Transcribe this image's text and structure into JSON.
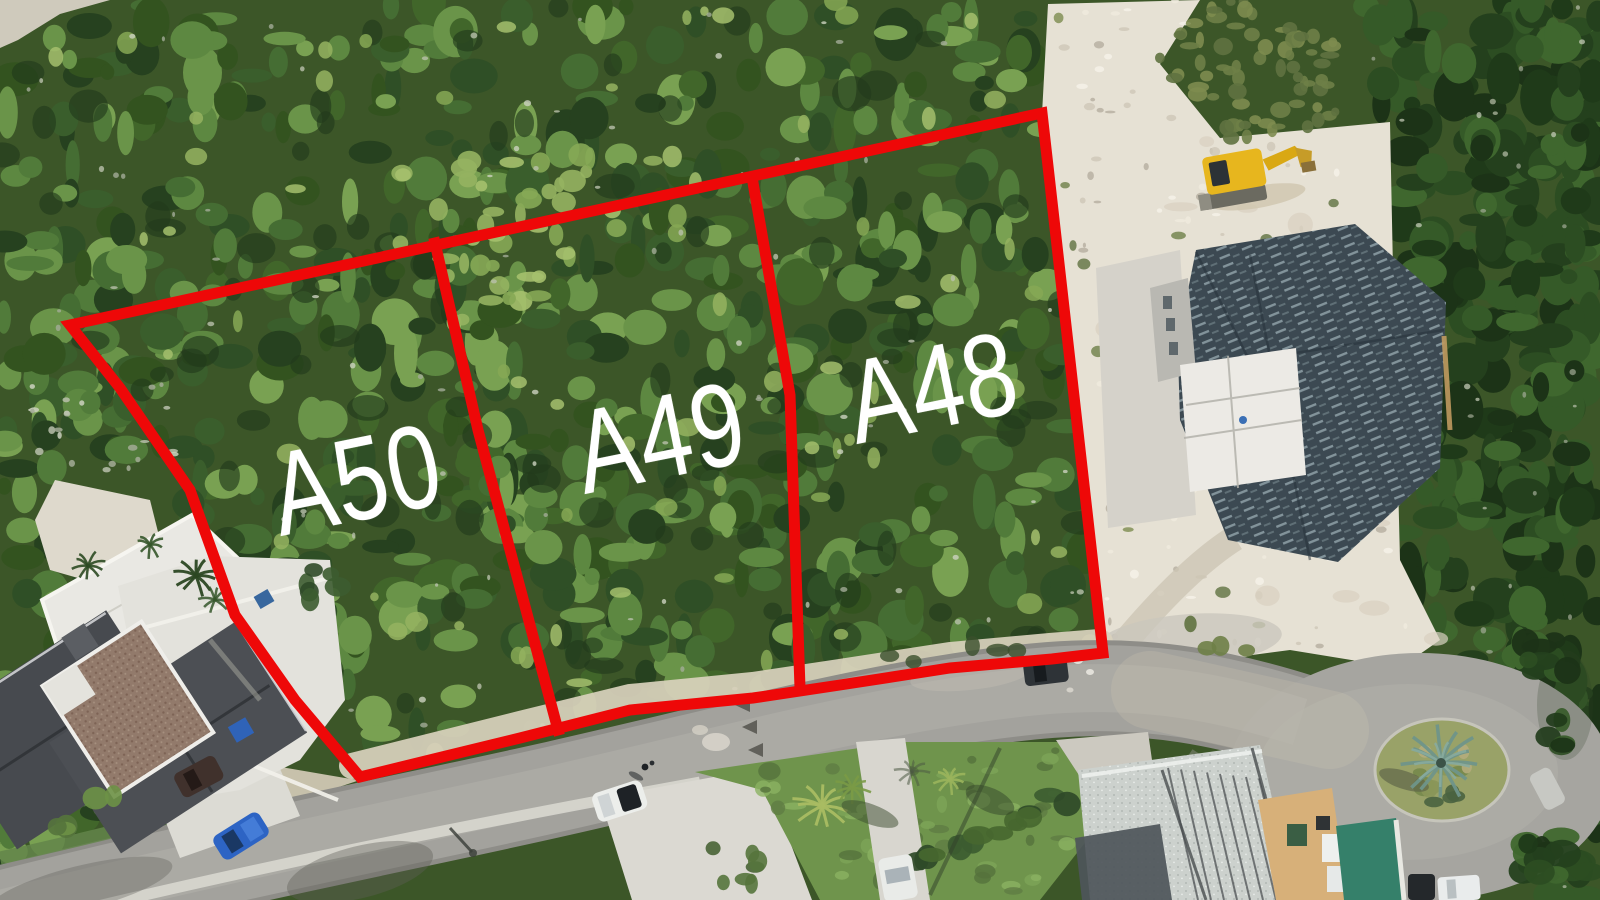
{
  "lots": {
    "boundary_color": "#ee0808",
    "label_color": "#ffffff",
    "items": [
      {
        "label": "A50"
      },
      {
        "label": "A49"
      },
      {
        "label": "A48"
      }
    ]
  }
}
